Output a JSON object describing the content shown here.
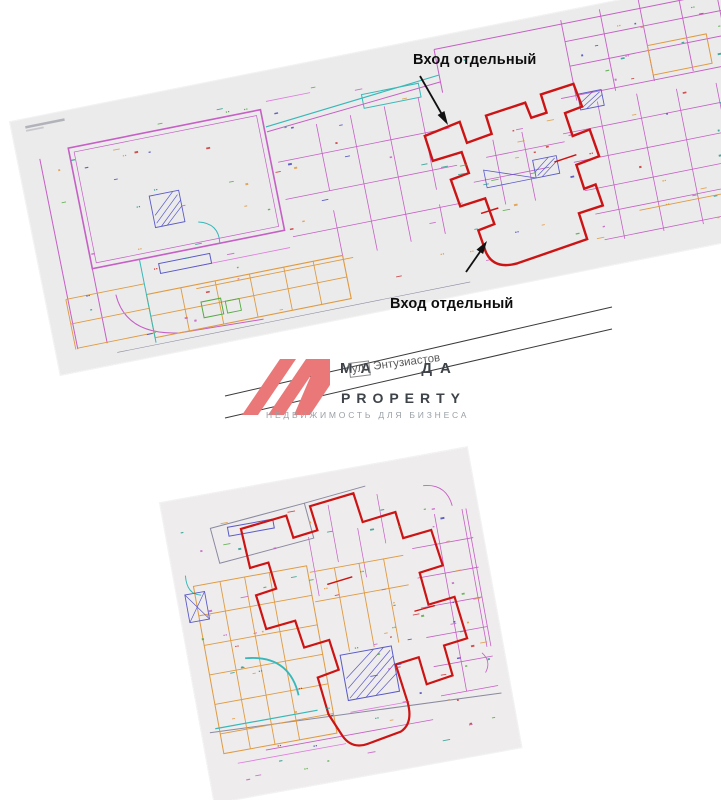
{
  "page": {
    "background": "#ffffff"
  },
  "annotations": {
    "entrance_label_top": "Вход отдельный",
    "entrance_label_bottom": "Вход отдельный"
  },
  "watermark": {
    "brand_left": "МА",
    "brand_right": "ДА",
    "property_label": "PROPERTY",
    "tagline": "НЕДВИЖИМОСТЬ ДЛЯ БИЗНЕСА",
    "street_prefix": "ул.",
    "street_name": "Энтузиастов",
    "logo_color": "#ea7878",
    "brand_text_color": "#3d4348",
    "tagline_color": "#98a0a6",
    "strike_line_color": "#3a3a3a"
  },
  "plans": {
    "highlight_color": "#cc1414",
    "paper_top": "#ebebeb",
    "paper_bottom": "#eeecec"
  },
  "decor_palette": [
    "#cc3333",
    "#c65fc6",
    "#4646bb",
    "#2a9d8f",
    "#e09a40",
    "#55aa44"
  ]
}
